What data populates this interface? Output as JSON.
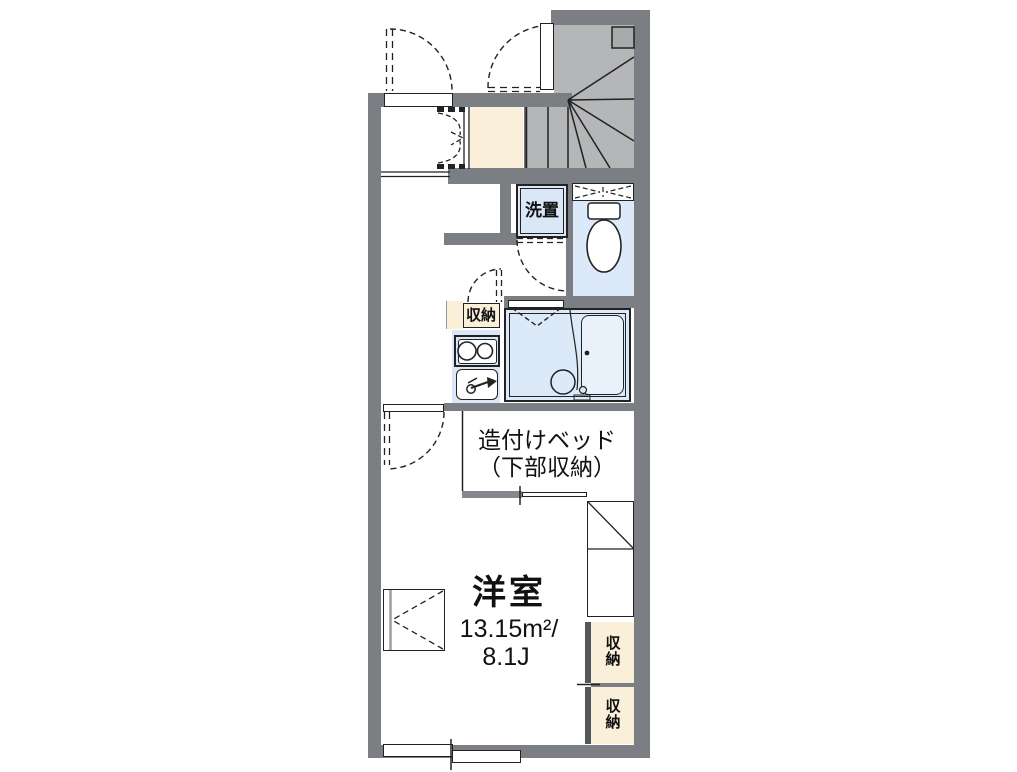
{
  "plan": {
    "type": "apartment-floor-plan",
    "rooms": {
      "main_room": {
        "name": "洋室",
        "area_sqm": "13.15m²/",
        "area_tatami": "8.1J"
      },
      "built_in_bed": {
        "line1": "造付けベッド",
        "line2": "（下部収納）"
      },
      "laundry_space": {
        "label": "洗置"
      },
      "kitchen_storage": {
        "label": "収納"
      },
      "storage_upper": {
        "label": "収納"
      },
      "storage_lower": {
        "label": "収納"
      }
    },
    "features": [
      "stairs",
      "toilet",
      "unit-bath",
      "two-burner-stove",
      "sink",
      "refrigerator-space",
      "windows",
      "entry"
    ],
    "colors": {
      "wall": "#7b7e83",
      "stairs_fill": "#b5b6b8",
      "entry_floor": "#faf0d9",
      "wet_room_floor": "#dce9f8",
      "fixture_fill": "#d9e7f7",
      "storage_fill": "#faf0d9",
      "line": "#222222",
      "background": "#ffffff"
    }
  }
}
